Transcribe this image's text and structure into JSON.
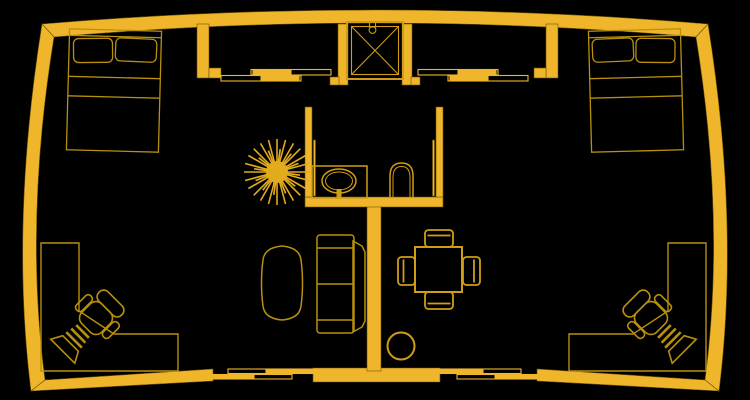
{
  "scene": {
    "label": "Apartment floor plan, gold line drawing on black",
    "style": "CAD outline drawing",
    "background": "#000000"
  },
  "colors": {
    "background": "#000000",
    "wall": "#EFB62B",
    "wall_edge": "#6b5104",
    "furniture": "#B8900E",
    "fixture": "#Cf9E14",
    "plant": "#E2AB1E"
  },
  "objects": {
    "bed_left": "Double bed with two pillows (left bedroom)",
    "bed_right": "Double bed with two pillows (right bedroom)",
    "desk_left": "L-shaped corner desk (bottom left)",
    "desk_right": "L-shaped corner desk (bottom right)",
    "office_chair_left": "Office chair at left desk",
    "office_chair_right": "Office chair at right desk",
    "shower": "Shower stall with cross pattern",
    "sink": "Vanity counter with oval sink",
    "toilet": "Toilet",
    "plant": "Potted plant",
    "sofa": "Two-seat sofa",
    "coffee_table": "Oval side table",
    "dining_table": "Square dining table with four chairs",
    "stool": "Round stool",
    "sliding_doors": "Sliding bypass doors (top and bottom openings)"
  }
}
